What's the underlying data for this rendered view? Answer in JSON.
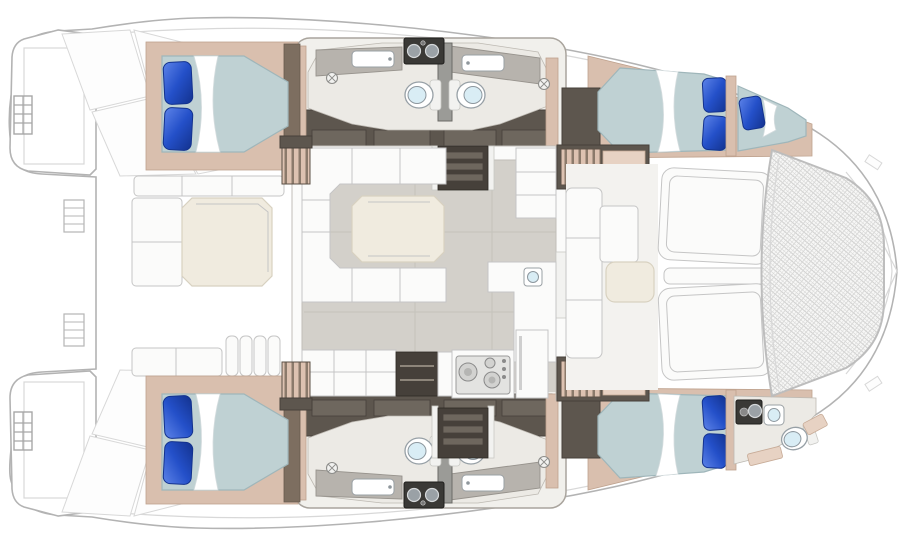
{
  "title": "Catamaran interior floor plan",
  "orientation": {
    "bow_direction": "right",
    "stern_direction": "left"
  },
  "colors": {
    "hull_outline": "#b3b3b3",
    "deck_line": "#d8d8d8",
    "salon_floor": "#d3d0ca",
    "floor_line": "#c5c2bb",
    "heads_floor": "#eceae5",
    "joinery_dark": "#5d564e",
    "joinery_deep": "#46403a",
    "cabinet_panel": "#6e675e",
    "tan": "#d9bfae",
    "tan_light": "#e7d2c3",
    "wood": "#7d6e60",
    "mattress": "#bfd1d3",
    "mattress_deep": "#9fb6ba",
    "pillow": "#2450c9",
    "pillow_deep": "#13328e",
    "pillow_highlight": "#5d83e8",
    "sheet": "#ffffff",
    "counter": "#b7b3ad",
    "table_cream": "#f0ebdf",
    "toilet_bowl": "#d9edf5",
    "fixture_metal": "#9aa1a6",
    "appliance_dark": "#3a3936",
    "seat_white": "#fbfbfa",
    "seat_line": "#c5c5c5",
    "mesh_line": "#d0d0cf"
  },
  "areas": [
    {
      "name": "aft cockpit",
      "features": [
        "dining table",
        "L-bench",
        "aft bench",
        "slatted seat"
      ]
    },
    {
      "name": "salon",
      "features": [
        "U-settee",
        "salon table",
        "storage cabinet",
        "L-counter with sink",
        "hull stairwells"
      ]
    },
    {
      "name": "galley",
      "features": [
        "counter",
        "open shelves",
        "cooktop",
        "refrigerator"
      ]
    },
    {
      "name": "port hull (top)",
      "features": [
        "aft double berth",
        "head with toilet, basin, shower",
        "forward double berth",
        "forepeak berth"
      ]
    },
    {
      "name": "starboard hull (bottom)",
      "features": [
        "aft double berth",
        "head with toilet, basin, shower",
        "forward double berth",
        "bow head with toilet and basin"
      ]
    },
    {
      "name": "foredeck",
      "features": [
        "forward cockpit seating",
        "cocktail table",
        "two sun pads",
        "bow trampoline"
      ]
    }
  ],
  "fixtures": {
    "double_berths": 4,
    "single_berths": 1,
    "toilets": 5,
    "basins": 6,
    "shower_drains": 4,
    "pillows": 9,
    "twin_basin_vanities": 2
  }
}
